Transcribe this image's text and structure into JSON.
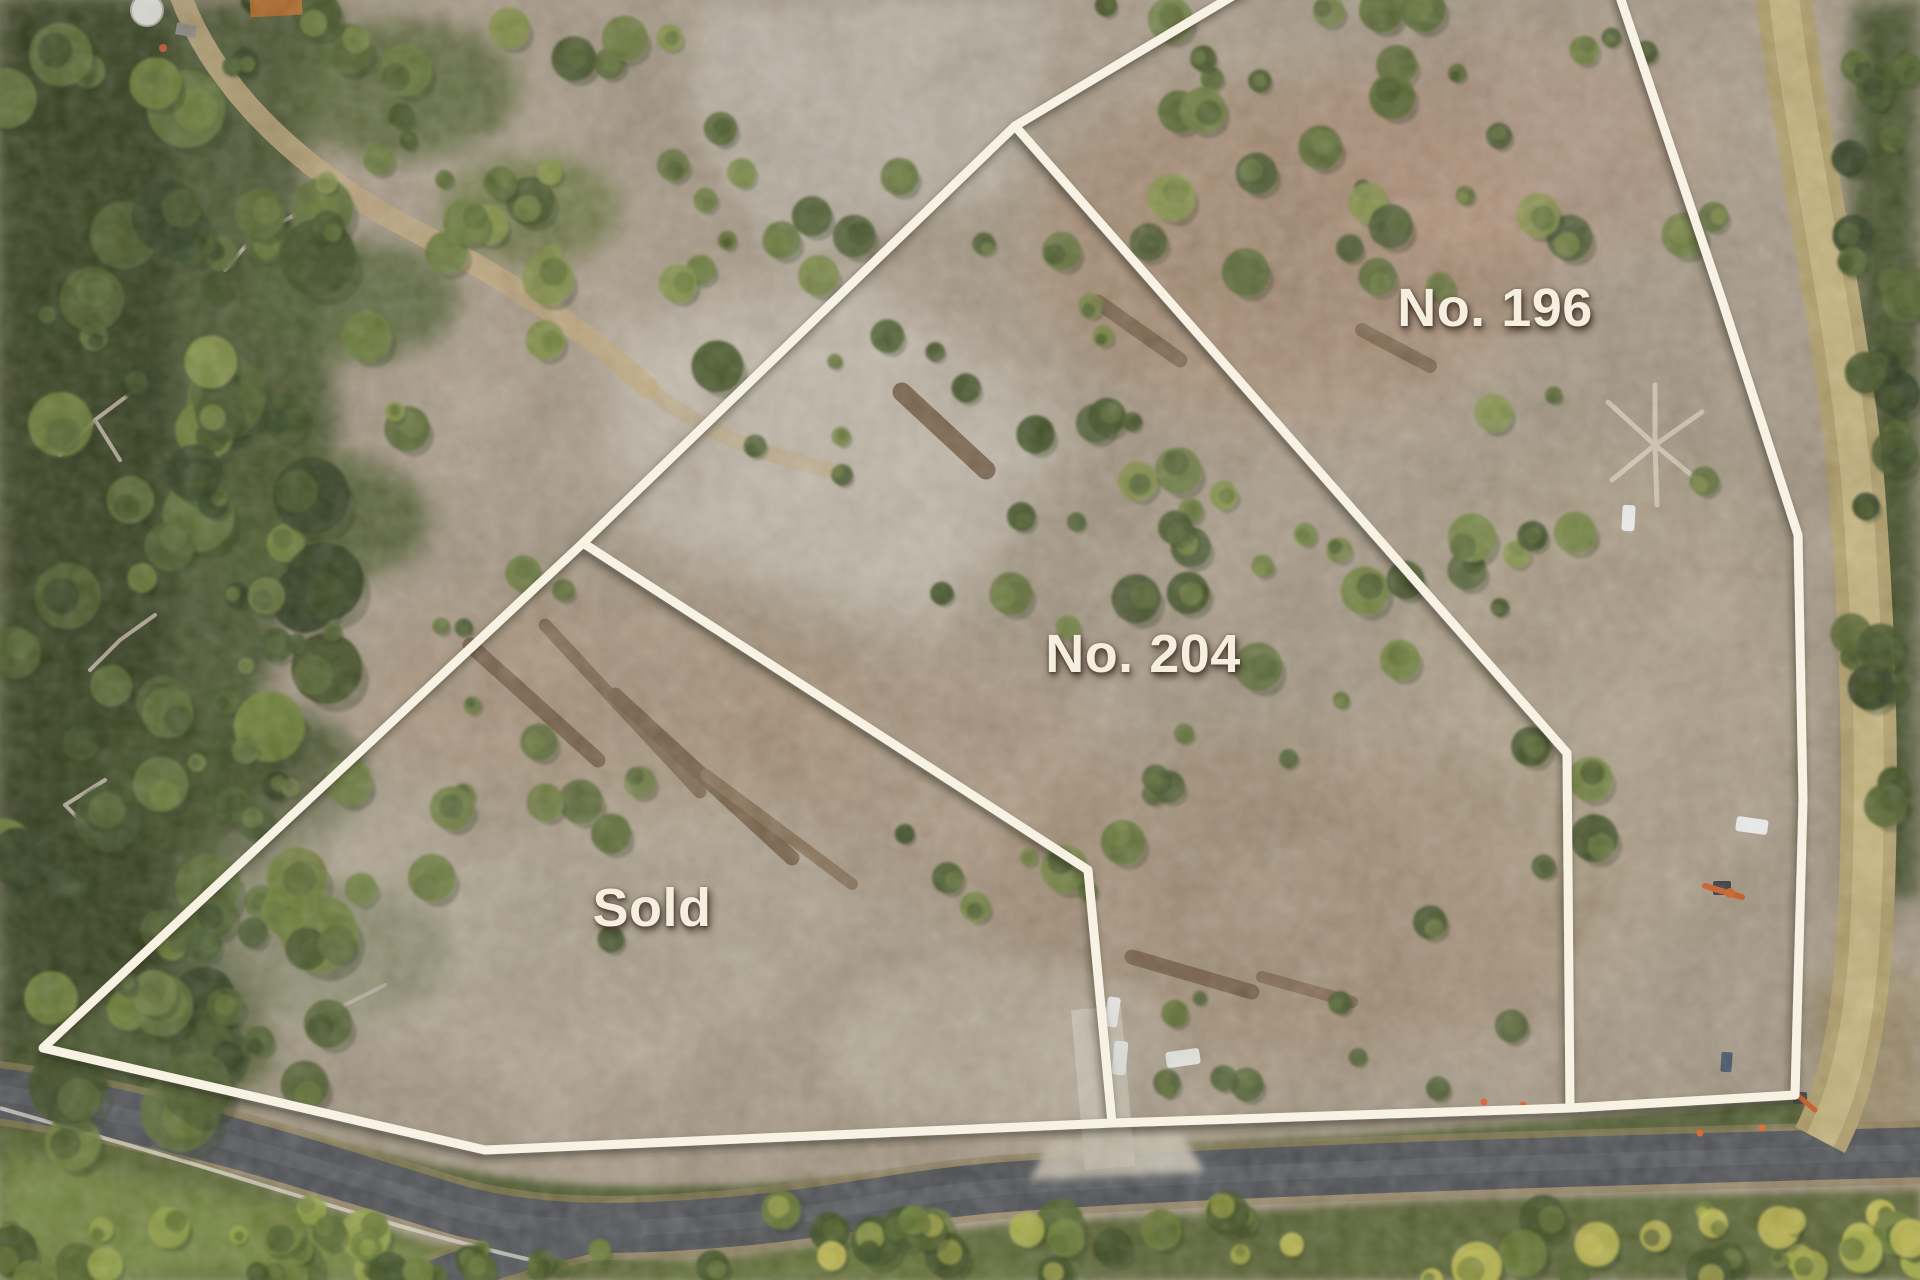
{
  "overlay": {
    "line_color": "#f7f2e4",
    "line_width": 9,
    "label_color": "#f6efe0",
    "boundaries": [
      {
        "name": "outer-west-and-south",
        "points": [
          [
            1246,
            -12
          ],
          [
            1015,
            126
          ],
          [
            583,
            543
          ],
          [
            43,
            1048
          ],
          [
            485,
            1150
          ],
          [
            1112,
            1123
          ],
          [
            1570,
            1108
          ],
          [
            1795,
            1095
          ]
        ]
      },
      {
        "name": "east-along-track",
        "points": [
          [
            1617,
            -12
          ],
          [
            1722,
            300
          ],
          [
            1798,
            535
          ],
          [
            1803,
            800
          ],
          [
            1795,
            1095
          ]
        ]
      },
      {
        "name": "divider-204-196",
        "points": [
          [
            1015,
            126
          ],
          [
            1567,
            753
          ],
          [
            1570,
            1108
          ]
        ]
      },
      {
        "name": "divider-sold-204",
        "points": [
          [
            583,
            543
          ],
          [
            1088,
            870
          ],
          [
            1112,
            1123
          ]
        ]
      }
    ],
    "lots": [
      {
        "id": "lot-196",
        "label": "No. 196",
        "x": 1495,
        "y": 308
      },
      {
        "id": "lot-204",
        "label": "No. 204",
        "x": 1143,
        "y": 654
      },
      {
        "id": "lot-sold",
        "label": "Sold",
        "x": 652,
        "y": 908
      }
    ]
  }
}
